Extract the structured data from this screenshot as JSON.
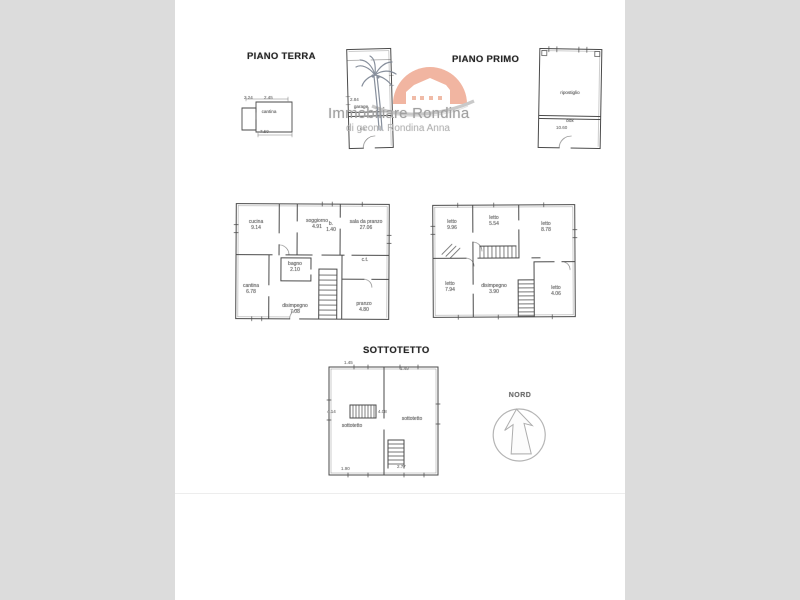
{
  "page": {
    "background": "#dcdcdc",
    "photo_background": "#ffffff",
    "drawing_line_color": "#4a4a4a"
  },
  "titles": {
    "piano_terra": "PIANO TERRA",
    "piano_primo": "PIANO PRIMO",
    "sottotetto": "SOTTOTETTO"
  },
  "compass": {
    "label": "NORD"
  },
  "watermark": {
    "name": "Immobiliare Rondina",
    "subtitle": "di geom. Rondina Anna",
    "colors": {
      "sun": "#f1b09a",
      "house": "#ffffff",
      "swoosh": "#c5c5c5",
      "palm": "#7e8795",
      "text": "#a0a0a0",
      "subtext": "#b5b5b5"
    }
  },
  "plans": {
    "cantina_annex": {
      "room": "cantina",
      "dims": {
        "top_left": "2.24",
        "top_right": "2.45",
        "bottom": "7.50"
      }
    },
    "garage_annex": {
      "upper_dim": "2.84",
      "upper_room": "garage",
      "lower_room": "c.t."
    },
    "storage_annex": {
      "upper_room": "ripostiglio",
      "lower_room": "box",
      "lower_dim": "10.60"
    },
    "piano_terra": {
      "rooms": [
        {
          "name": "cucina",
          "area": "9.14"
        },
        {
          "name": "soggiorno",
          "area": "4.91"
        },
        {
          "name": "sala da pranzo",
          "area": "27.06"
        },
        {
          "name": "b.",
          "area": "1.40"
        },
        {
          "name": "bagno",
          "area": "2.10"
        },
        {
          "name": "cantina",
          "area": "6.78"
        },
        {
          "name": "disimpegno",
          "area": "7.08"
        },
        {
          "name": "pranzo",
          "area": "4.80"
        },
        {
          "name": "c.t.",
          "area": ""
        }
      ]
    },
    "piano_primo": {
      "rooms": [
        {
          "name": "letto",
          "area": "9.96"
        },
        {
          "name": "letto",
          "area": "5.54"
        },
        {
          "name": "letto",
          "area": "8.78"
        },
        {
          "name": "letto",
          "area": "7.94"
        },
        {
          "name": "disimpegno",
          "area": "3.90"
        },
        {
          "name": "letto",
          "area": "4.06"
        }
      ]
    },
    "sottotetto": {
      "rooms": [
        {
          "name": "sottotetto"
        },
        {
          "name": "sottotetto"
        }
      ],
      "dims": {
        "top_left": "1.45",
        "top_right": "1.49",
        "left": "4.14",
        "center": "4.08",
        "bottom_left": "1.90",
        "bottom_right": "2.77"
      }
    }
  }
}
